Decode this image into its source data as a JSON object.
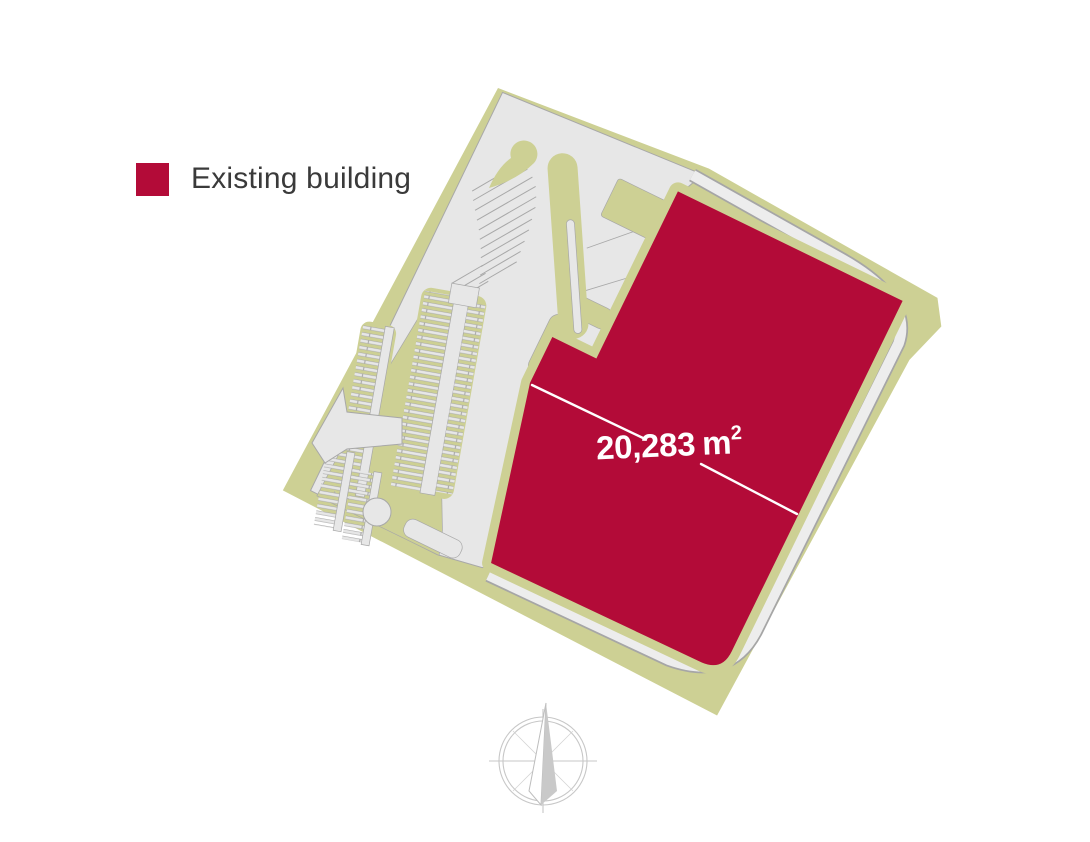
{
  "legend": {
    "label": "Existing building",
    "swatch_color": "#B30B38"
  },
  "area_label": {
    "value": "20,283",
    "unit": "m",
    "exponent": "2",
    "full_text": "20,283 m²"
  },
  "map": {
    "colors": {
      "building": "#B30B38",
      "land": "#CDD094",
      "pavement": "#E7E7E7",
      "pavement_outline": "#A8A8A8",
      "road": "#EDEDED",
      "road_casing": "#A6A6A6",
      "dimension_line": "#FFFFFF",
      "compass": "#C7C7C7"
    },
    "icons": [
      "north-compass-icon"
    ],
    "features": [
      "land-parcel",
      "paved-area",
      "perimeter-road",
      "parking-rows",
      "entrance-arrow",
      "existing-building"
    ]
  }
}
